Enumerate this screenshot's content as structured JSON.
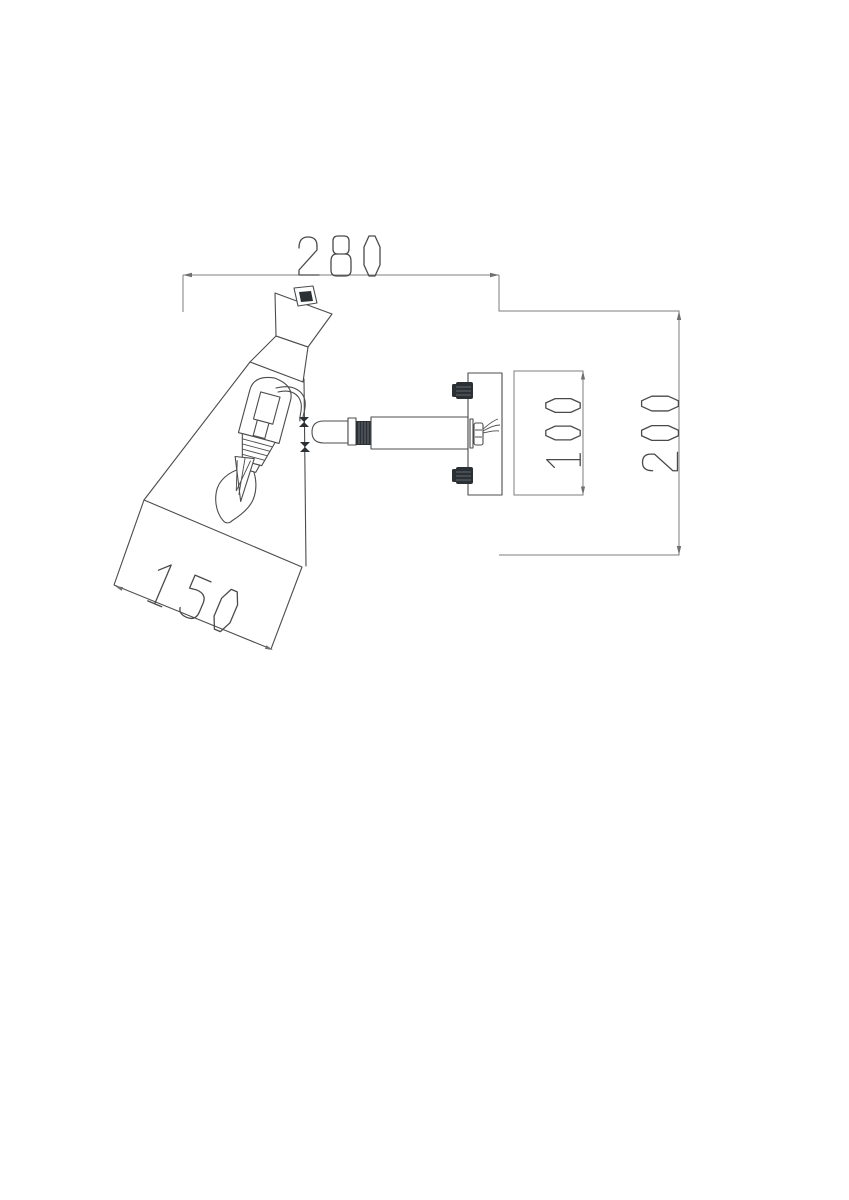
{
  "drawing": {
    "description_label": "",
    "canvas": {
      "width": 849,
      "height": 1200,
      "background": "#ffffff"
    },
    "colors": {
      "object_line": "#4c4c4c",
      "dimension_line": "#7e7e7e",
      "dimension_text": "#4a4a4a",
      "dark_fill": "#2b3034"
    },
    "dimensions": [
      {
        "name": "overall-width",
        "value": "280",
        "orientation": "horizontal"
      },
      {
        "name": "overall-height",
        "value": "200",
        "orientation": "vertical"
      },
      {
        "name": "backplate-height",
        "value": "100",
        "orientation": "vertical"
      },
      {
        "name": "shade-diameter",
        "value": "150",
        "orientation": "aligned"
      }
    ]
  }
}
